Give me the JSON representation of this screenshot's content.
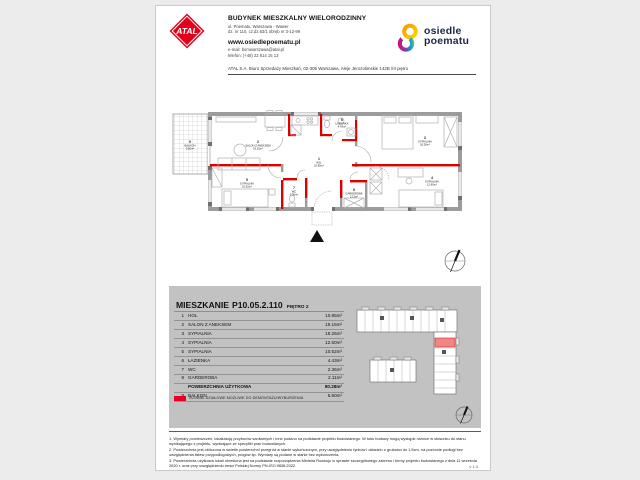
{
  "header": {
    "building_title": "BUDYNEK MIESZKALNY WIELORODZINNY",
    "address_line1": "ul. Poematu, Warszawa - Wawer",
    "address_line2": "dz. nr 110, cz.dz.63/1 obręb nr 3-12-99",
    "website": "www.osiedlepoematu.pl",
    "email": "e-mail: bomwarszawa@atal.pl",
    "phone": "telefon: (+48) 22 814 15 13",
    "office": "ATAL S.A. Biuro Sprzedaży Mieszkań, 02-305 Warszawa, Aleje Jerozolimskie 142B /III piętro",
    "atal_logo_text": "ATAL",
    "brand_line1": "osiedle",
    "brand_line2": "poematu"
  },
  "apartment": {
    "title_label": "MIESZKANIE",
    "unit_number": "P10.05.2.110",
    "floor_label": "PIĘTRO 2"
  },
  "rooms_table": {
    "rows": [
      {
        "no": "1",
        "name": "HOL",
        "area": "10.85m²"
      },
      {
        "no": "2",
        "name": "SALON Z ANEKSEM",
        "area": "19.15m²"
      },
      {
        "no": "3",
        "name": "SYPIALNIA",
        "area": "18.26m²"
      },
      {
        "no": "4",
        "name": "SYPIALNIA",
        "area": "12.60m²"
      },
      {
        "no": "5",
        "name": "SYPIALNIA",
        "area": "10.52m²"
      },
      {
        "no": "6",
        "name": "ŁAZIENKA",
        "area": "4.43m²"
      },
      {
        "no": "7",
        "name": "WC",
        "area": "2.36m²"
      },
      {
        "no": "8",
        "name": "GARDEROBA",
        "area": "2.11m²"
      },
      {
        "no": "",
        "name": "POWIERZCHNIA UŻYTKOWA",
        "area": "80.28m²",
        "bold": true
      },
      {
        "no": "9",
        "name": "BALKON",
        "area": "5.60m²"
      }
    ],
    "legend": "ŚCIANKI DZIAŁOWE MOŻLIWE DO DEMONTAŻU/WYBURZENIA"
  },
  "footnotes": [
    "1. Wymiary pomieszczeń, lokalizację przyborów sanitarnych i inne podano na podstawie projektu budowlanego. W toku budowy mogą wystąpić różnice w stosunku do stanu wynikającego z projektu, wynikające ze specyfiki prac budowlanych.",
    "2. Powierzchnia jest obliczona w świetle powierzchni przegród w stanie wykończonym, przy uwzględnieniu tynków i okładzin o grubości do 1,5cm, na poziomie podłogi bez uwzględnienia listew przypodłogowych, progów itp. Wymiary są podane w stanie bez wykończenia.",
    "3. Powierzchnia użytkowa lokali określona jest na podstawie rozporządzenia Ministra Rozwoju w sprawie szczegółowego zakresu i formy projektu budowlanego z dnia 11 września 2020 r. oraz przy uwzględnieniu treści Polskiej Normy PN-ISO 9836:2022."
  ],
  "version": "v 1.0",
  "colors": {
    "atal_red": "#e2001a",
    "brand_navy": "#1c2749",
    "panel_gray": "#c2c2c2",
    "wall_gray": "#9c9c9c",
    "partition_red": "#dd0000",
    "legend_red": "#e8001d",
    "keyplan_unit_red": "#ef8683"
  }
}
